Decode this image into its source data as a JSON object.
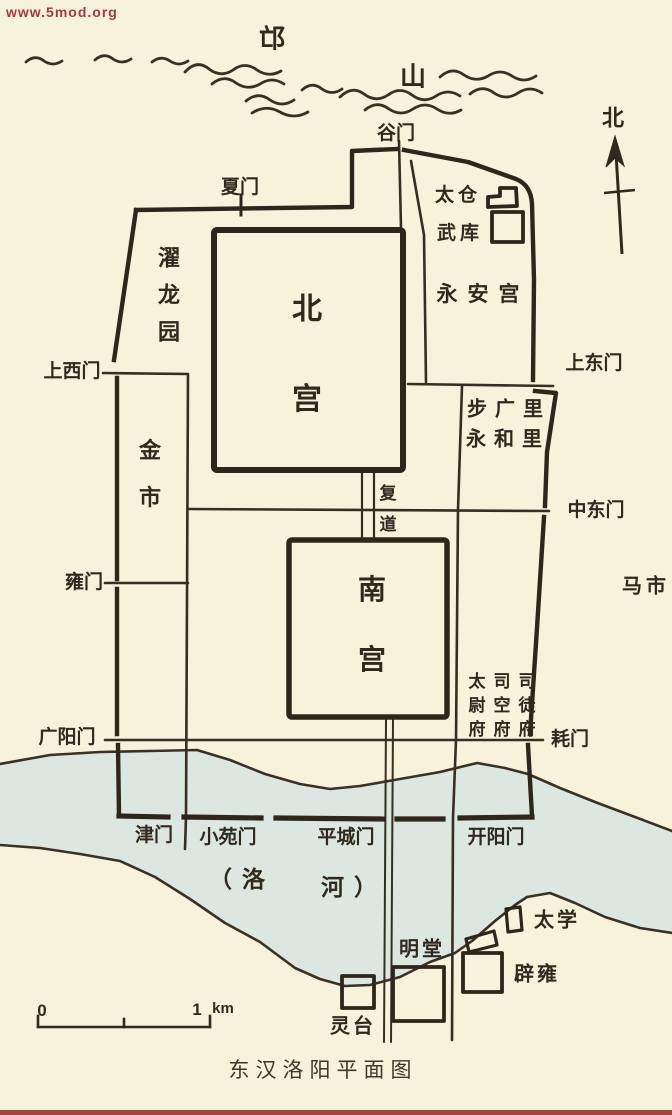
{
  "colors": {
    "paper": "#f7f2dc",
    "ink": "#31281e",
    "river": "#dbe7e0",
    "watermark_red": "#a2242b"
  },
  "watermark": {
    "text": "www.5mod.org"
  },
  "compass": {
    "north_label": "北"
  },
  "mountain": {
    "char1": "邙",
    "char2": "山"
  },
  "city": {
    "gates": {
      "gu": "谷门",
      "xia": "夏门",
      "shangxi": "上西门",
      "shangdong": "上东门",
      "zhongdong": "中东门",
      "yong": "雍门",
      "guangyang": "广阳门",
      "hao": "耗门",
      "jin": "津门",
      "xiaoyuan": "小苑门",
      "pingcheng": "平城门",
      "kaiyang": "开阳门"
    },
    "palaces": {
      "north": "北宫",
      "south": "南宫",
      "yongan": "永安宫"
    },
    "sites": {
      "taicang": "太仓",
      "wuku": "武库",
      "zhuolong": "濯龙园",
      "jinshi": "金市",
      "fudao": "复道",
      "buguangli": "步广里",
      "yonghelli": "永和里",
      "mashi": "马市",
      "taiweifu": "太尉府",
      "sikongfu": "司空府",
      "situfu": "司徒府"
    },
    "south_suburb": {
      "taixue": "太学",
      "mingtang": "明堂",
      "biyong": "辟雍",
      "lingtai": "灵台"
    },
    "river": {
      "label_left": "（洛",
      "label_right": "河）"
    }
  },
  "scale_bar": {
    "zero": "0",
    "one": "1",
    "unit": "km"
  },
  "caption": "东汉洛阳平面图"
}
